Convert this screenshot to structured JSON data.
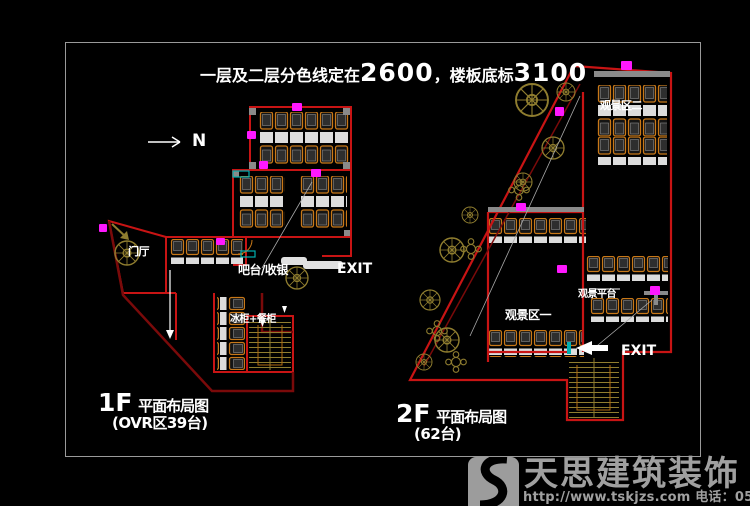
{
  "title": {
    "part1": "一层及二层分色线定在",
    "num1": "2600",
    "part2": "，楼板底标",
    "num2": "3100"
  },
  "north_label": "N",
  "plan_1f": {
    "entrance": "门厅",
    "bar": "吧台/收银",
    "exit": "EXIT",
    "cabinet": "冰柜+餐柜",
    "caption_floor": "1F",
    "caption_text": "平面布局图",
    "caption_sub": "(OVR区39台)"
  },
  "plan_2f": {
    "area_top": "观景区二",
    "area_mid": "观景区一",
    "platform": "观景平台",
    "exit": "EXIT",
    "caption_floor": "2F",
    "caption_text": "平面布局图",
    "caption_sub": "(62台)"
  },
  "watermark": {
    "company": "天思建筑装饰",
    "contact": "http://www.tskjzs.com 电话：0551-65568226"
  },
  "colors": {
    "background": "#000000",
    "frame": "#9a9a9a",
    "wall_red": "#c81414",
    "wall_dark_red": "#7a0a0a",
    "furniture_orange": "#c87818",
    "table_white": "#dcdcdc",
    "plant_olive": "#8f7d2f",
    "marker_magenta": "#ff18ff",
    "railing_gray": "#8a8a8a",
    "accent_cyan": "#00b0b0",
    "text_white": "#ffffff",
    "watermark_gray": "#a0a0a0"
  }
}
